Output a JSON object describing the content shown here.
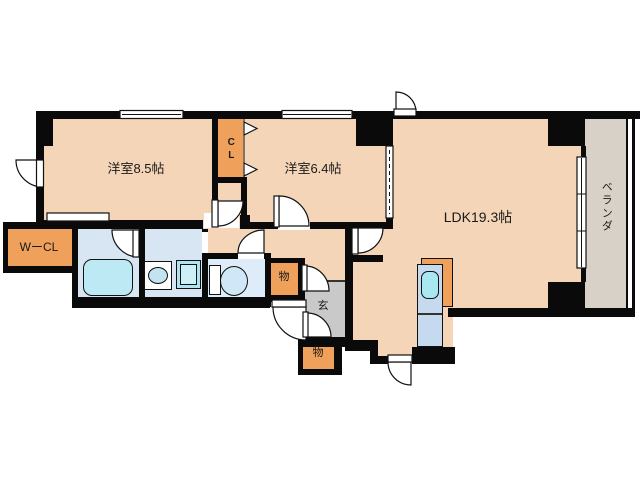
{
  "plan": {
    "type": "apartment-floor-plan",
    "labels": {
      "room85": "洋室8.5帖",
      "room64": "洋室6.4帖",
      "ldk": "LDK19.3帖",
      "cl": "CL",
      "wcl": "WーCL",
      "veranda": "ベランダ",
      "genkan": "玄",
      "storage_upper": "物",
      "storage_lower": "物"
    },
    "fixture_icons": [
      "bathtub-icon",
      "washbasin-icon",
      "washing-machine-icon",
      "toilet-icon",
      "kitchen-sink-icon",
      "door-swing-icon",
      "folding-closet-door-icon",
      "sliding-door-icon",
      "window-icon"
    ],
    "colors": {
      "floor_peach": "#F4D5B8",
      "closet_orange": "#EFA05A",
      "veranda_gray": "#D8D1C7",
      "genkan_gray": "#C9C9C9",
      "wet_blue": "#D8E6F4",
      "kitchen_blue": "#C5DAEE",
      "fixture_cyan": "#BCE9F4",
      "wall_black": "#0A0A0A"
    }
  }
}
